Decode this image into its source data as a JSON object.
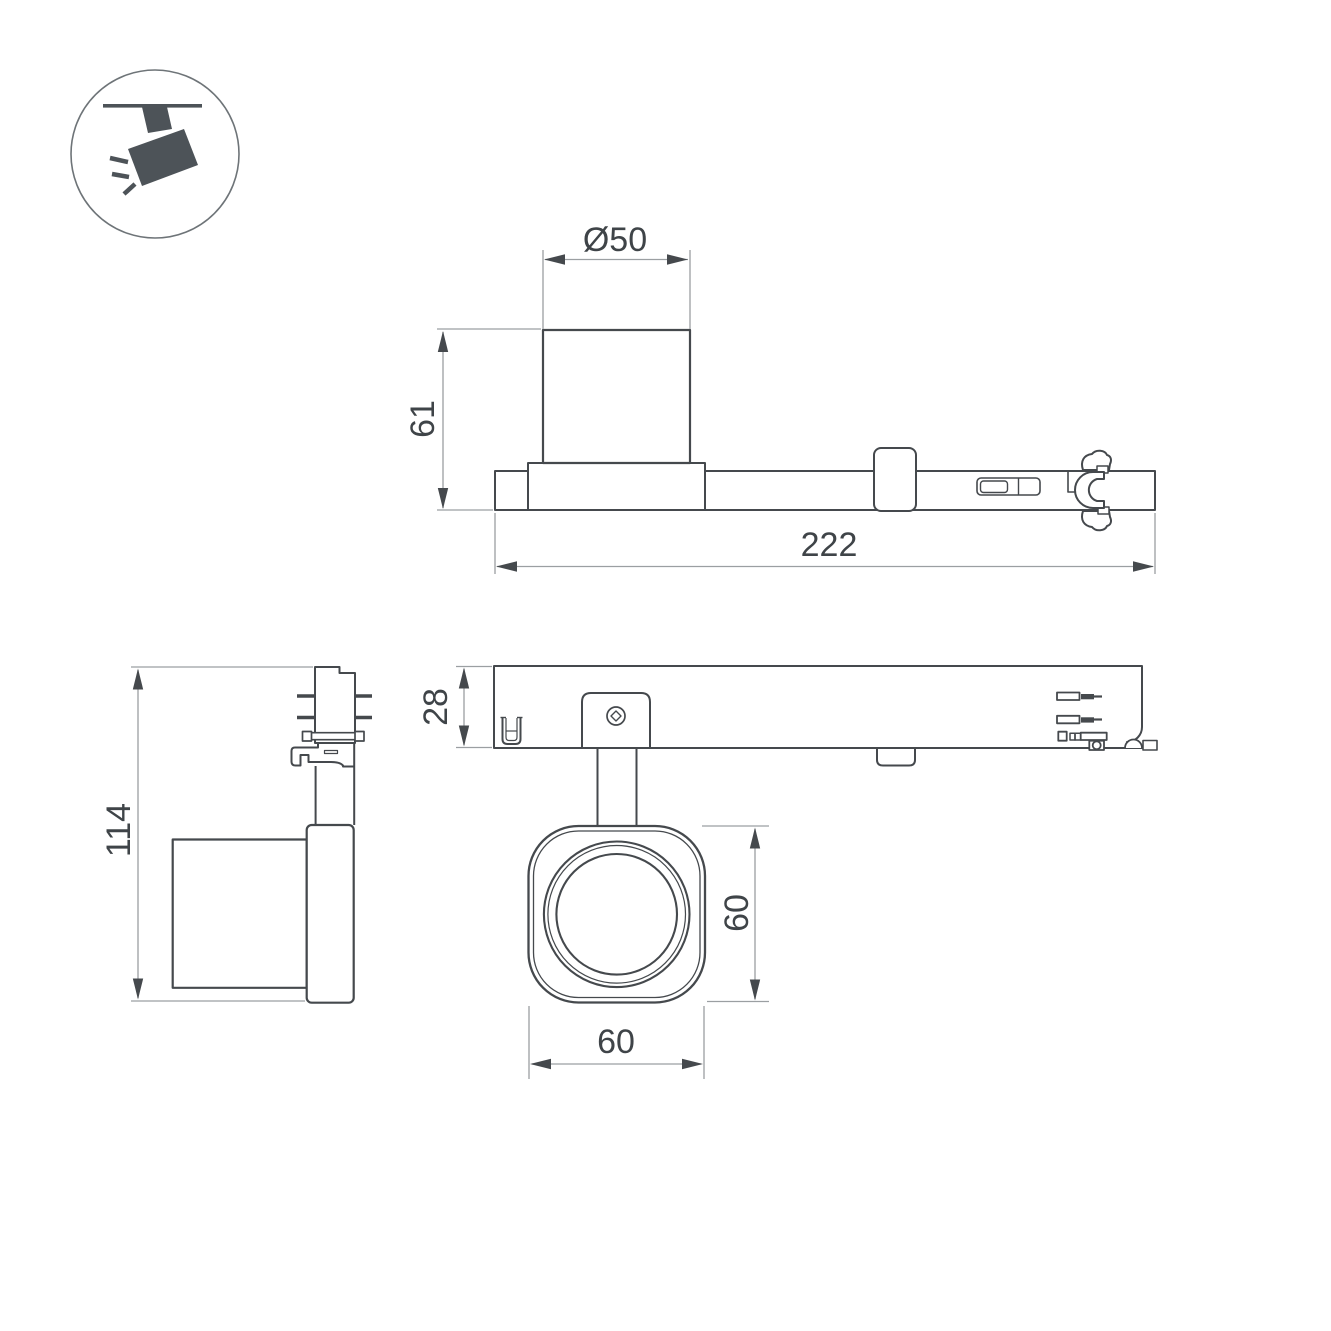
{
  "drawing": {
    "colors": {
      "object_line": "#45494d",
      "dimension_line": "#9b9fa2",
      "arrow": "#45494d",
      "text": "#3f4448",
      "icon": "#4d5358",
      "icon_circle": "#6e7478"
    },
    "icon": {
      "name": "ceiling-track-spotlight-icon"
    },
    "views": {
      "side_elevation": {
        "dim_diameter": "Ø50",
        "dim_body_height": "61",
        "dim_total_length": "222"
      },
      "plan": {
        "dim_track_height": "28",
        "dim_head_height": "60",
        "dim_head_width": "60"
      },
      "end_elevation": {
        "dim_total_height": "114"
      }
    }
  }
}
